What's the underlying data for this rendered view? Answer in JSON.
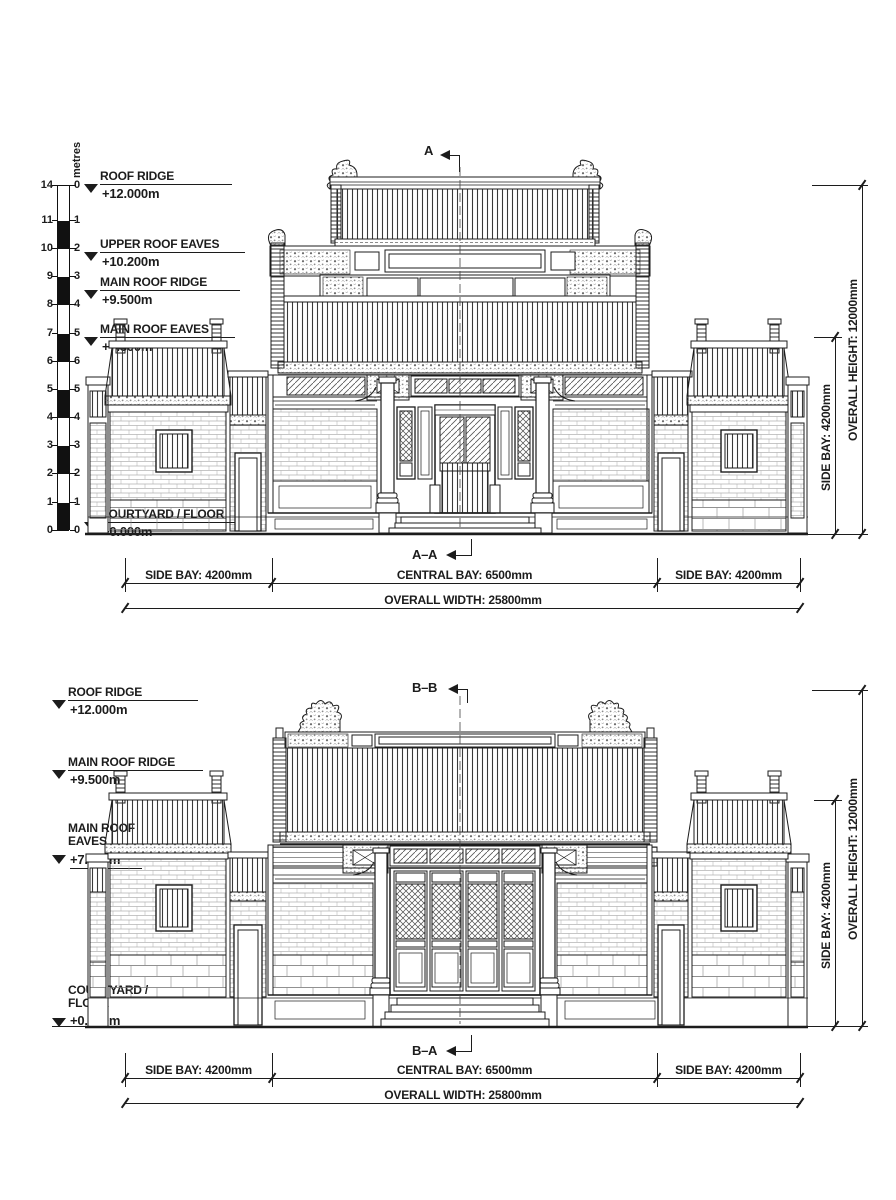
{
  "drawing": {
    "colors": {
      "ink": "#1c1c1c",
      "paper": "#ffffff"
    },
    "scale_bar": {
      "unit": "metres",
      "ticks": [
        {
          "l": "14",
          "r": "0"
        },
        {
          "l": "11",
          "r": "1"
        },
        {
          "l": "10",
          "r": "2"
        },
        {
          "l": "9",
          "r": "3"
        },
        {
          "l": "8",
          "r": "4"
        },
        {
          "l": "7",
          "r": "5"
        },
        {
          "l": "6",
          "r": "6"
        },
        {
          "l": "5",
          "r": "5"
        },
        {
          "l": "4",
          "r": "4"
        },
        {
          "l": "3",
          "r": "3"
        },
        {
          "l": "2",
          "r": "2"
        },
        {
          "l": "1",
          "r": "1"
        },
        {
          "l": "0",
          "r": "0"
        }
      ]
    },
    "elevation_a": {
      "marker_top": "A",
      "marker_bottom": "A–A",
      "levels": [
        {
          "label": "ROOF RIDGE",
          "value": "+12.000m"
        },
        {
          "label": "UPPER ROOF EAVES",
          "value": "+10.200m"
        },
        {
          "label": "MAIN ROOF RIDGE",
          "value": "+9.500m"
        },
        {
          "label": "MAIN ROOF EAVES",
          "value": "+7.800m"
        },
        {
          "label": "COURTYARD / FLOOR",
          "value": "+0.000m"
        }
      ],
      "dims": {
        "side_bay_left": "SIDE BAY: 4200mm",
        "central_bay": "CENTRAL BAY: 6500mm",
        "side_bay_right": "SIDE BAY: 4200mm",
        "overall_width": "OVERALL WIDTH: 25800mm",
        "side_bay_height": "SIDE BAY: 4200mm",
        "overall_height": "OVERALL HEIGHT: 12000mm"
      }
    },
    "elevation_b": {
      "marker_top": "B–B",
      "marker_bottom": "B–A",
      "levels": [
        {
          "label": "ROOF RIDGE",
          "value": "+12.000m"
        },
        {
          "label": "MAIN ROOF RIDGE",
          "value": "+9.500m"
        },
        {
          "label": "MAIN ROOF EAVES",
          "value": "+7.800m"
        },
        {
          "label": "COURTYARD / FLOOR",
          "value": "+0.000m"
        }
      ],
      "dims": {
        "side_bay_left": "SIDE BAY: 4200mm",
        "central_bay": "CENTRAL BAY: 6500mm",
        "side_bay_right": "SIDE BAY: 4200mm",
        "overall_width": "OVERALL WIDTH: 25800mm",
        "side_bay_height": "SIDE BAY: 4200mm",
        "overall_height": "OVERALL HEIGHT: 12000mm"
      }
    }
  }
}
